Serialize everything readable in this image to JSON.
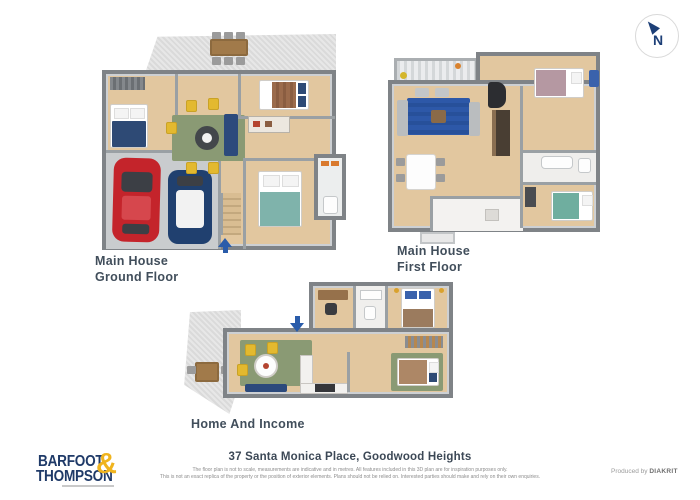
{
  "compass": {
    "letter": "N"
  },
  "plans": {
    "ground": {
      "line1": "Main House",
      "line2": "Ground Floor"
    },
    "first": {
      "line1": "Main House",
      "line2": "First Floor"
    },
    "income": {
      "line1": "Home And Income"
    }
  },
  "logo": {
    "word1": "BARFOOT",
    "word2": "THOMPSON",
    "amp": "&"
  },
  "footer": {
    "address": "37 Santa Monica Place, Goodwood Heights",
    "disclaimer1": "The floor plan is not to scale, measurements are indicative and in metres. All features included in this 3D plan are for inspiration purposes only.",
    "disclaimer2": "This is not an exact replica of the property or the position of exterior elements. Plans should not be relied on. Interested parties should make and rely on their own enquiries.",
    "produced_by": "Produced by ",
    "producer": "DIAKRIT"
  },
  "colors": {
    "logo_navy": "#1f3a68",
    "logo_gold": "#f0b41e",
    "entry_arrow_blue": "#2a5caa",
    "wood_floor": "#e2c79f",
    "wall_gray": "#7f8387"
  }
}
